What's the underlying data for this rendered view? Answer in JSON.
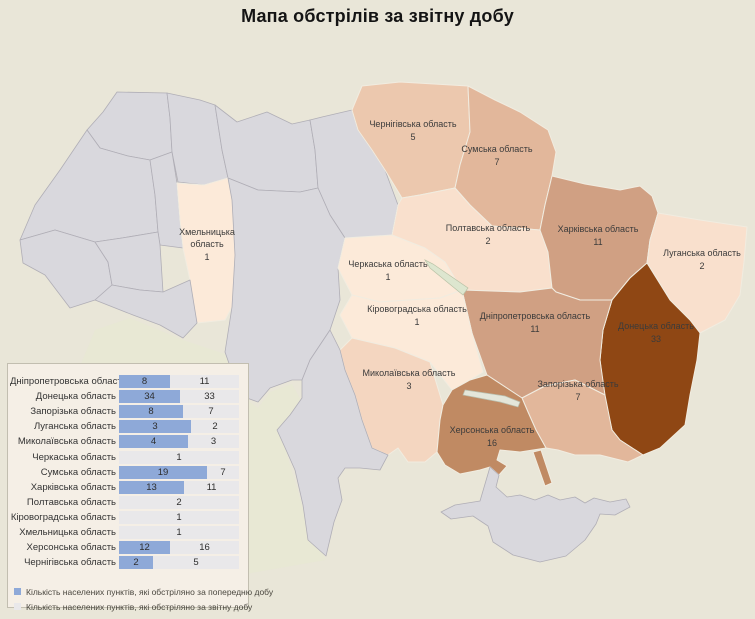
{
  "title": "Мапа обстрілів за звітну добу",
  "colors": {
    "page_bg": "#e9e6d8",
    "panel_bg": "#f5efe6",
    "panel_border": "#c2beb0",
    "bar_blue": "#8ea9d8",
    "bar_track": "#e9e8ea",
    "gray_region": "#d9d8dd",
    "region_border_gray": "#b0aeb6",
    "region_border_light": "#f1ece0",
    "text": "#2f2f2f"
  },
  "map": {
    "value_color_scale": {
      "1": "#fcead9",
      "2": "#f9e0cd",
      "3": "#f4d6c0",
      "5": "#ecc8ae",
      "7": "#e2b79b",
      "11": "#d0a083",
      "16": "#c08a63",
      "33": "#8f4714"
    },
    "regions": [
      {
        "id": "volyn",
        "gray": true
      },
      {
        "id": "rivne",
        "gray": true
      },
      {
        "id": "zhytomyr",
        "gray": true
      },
      {
        "id": "kyiv",
        "gray": true
      },
      {
        "id": "lviv",
        "gray": true
      },
      {
        "id": "ternopil",
        "gray": true
      },
      {
        "id": "zakarpattia",
        "gray": true
      },
      {
        "id": "ivanofrankivsk",
        "gray": true
      },
      {
        "id": "chernivtsi",
        "gray": true
      },
      {
        "id": "vinnytsia",
        "gray": true
      },
      {
        "id": "odesa",
        "gray": true
      },
      {
        "id": "crimea",
        "gray": true
      },
      {
        "id": "chernihiv",
        "label_lines": [
          "Чернігівська область"
        ],
        "value": 5,
        "fill": "#ecc8ae",
        "lx": 413,
        "ly": 127
      },
      {
        "id": "sumy",
        "label_lines": [
          "Сумська область"
        ],
        "value": 7,
        "fill": "#e2b79b",
        "lx": 497,
        "ly": 152
      },
      {
        "id": "khmelnytskyi",
        "label_lines": [
          "Хмельницька",
          "область"
        ],
        "value": 1,
        "fill": "#fcead9",
        "lx": 207,
        "ly": 235
      },
      {
        "id": "cherkasy",
        "label_lines": [
          "Черкаська область"
        ],
        "value": 1,
        "fill": "#fcead9",
        "lx": 388,
        "ly": 267
      },
      {
        "id": "kirovohrad",
        "label_lines": [
          "Кіровоградська область"
        ],
        "value": 1,
        "fill": "#fcead9",
        "lx": 417,
        "ly": 312
      },
      {
        "id": "poltava",
        "label_lines": [
          "Полтавська область"
        ],
        "value": 2,
        "fill": "#f9e0cd",
        "lx": 488,
        "ly": 231
      },
      {
        "id": "luhansk",
        "label_lines": [
          "Луганська область"
        ],
        "value": 2,
        "fill": "#f9e0cd",
        "lx": 702,
        "ly": 256
      },
      {
        "id": "mykolaiv",
        "label_lines": [
          "Миколаївська область"
        ],
        "value": 3,
        "fill": "#f4d6c0",
        "lx": 409,
        "ly": 376
      },
      {
        "id": "zaporizhzhia",
        "label_lines": [
          "Запорізька область"
        ],
        "value": 7,
        "fill": "#e2b79b",
        "lx": 578,
        "ly": 387
      },
      {
        "id": "kharkiv",
        "label_lines": [
          "Харківська область"
        ],
        "value": 11,
        "fill": "#d0a083",
        "lx": 598,
        "ly": 232
      },
      {
        "id": "dnipro",
        "label_lines": [
          "Дніпропетровська область"
        ],
        "value": 11,
        "fill": "#d0a083",
        "lx": 535,
        "ly": 319
      },
      {
        "id": "kherson",
        "label_lines": [
          "Херсонська область"
        ],
        "value": 16,
        "fill": "#c08a63",
        "lx": 492,
        "ly": 433
      },
      {
        "id": "arabat",
        "fill": "#c08a63"
      },
      {
        "id": "donetsk",
        "label_lines": [
          "Донецька область"
        ],
        "value": 33,
        "fill": "#8f4714",
        "lx": 656,
        "ly": 329
      }
    ]
  },
  "chart_data": {
    "type": "bar",
    "subtype": "horizontal-100%-stacked",
    "categories": [
      "Дніпропетровська область",
      "Донецька область",
      "Запорізька область",
      "Луганська область",
      "Миколаївська область",
      "Черкаська область",
      "Сумська область",
      "Харківська область",
      "Полтавська область",
      "Кіровоградська область",
      "Хмельницька область",
      "Херсонська область",
      "Чернігівська область"
    ],
    "series": [
      {
        "name": "Кількість населених пунктів, які обстріляно за попередню добу",
        "color": "#8ea9d8",
        "values": [
          8,
          34,
          8,
          3,
          4,
          0,
          19,
          13,
          0,
          0,
          0,
          12,
          2
        ]
      },
      {
        "name": "Кількість населених пунктів, які обстріляно за звітну добу",
        "color": "#e9e8ea",
        "values": [
          11,
          33,
          7,
          2,
          3,
          1,
          7,
          11,
          2,
          1,
          1,
          16,
          5
        ]
      }
    ],
    "legend_position": "bottom-left",
    "bar_area_px": 120
  }
}
